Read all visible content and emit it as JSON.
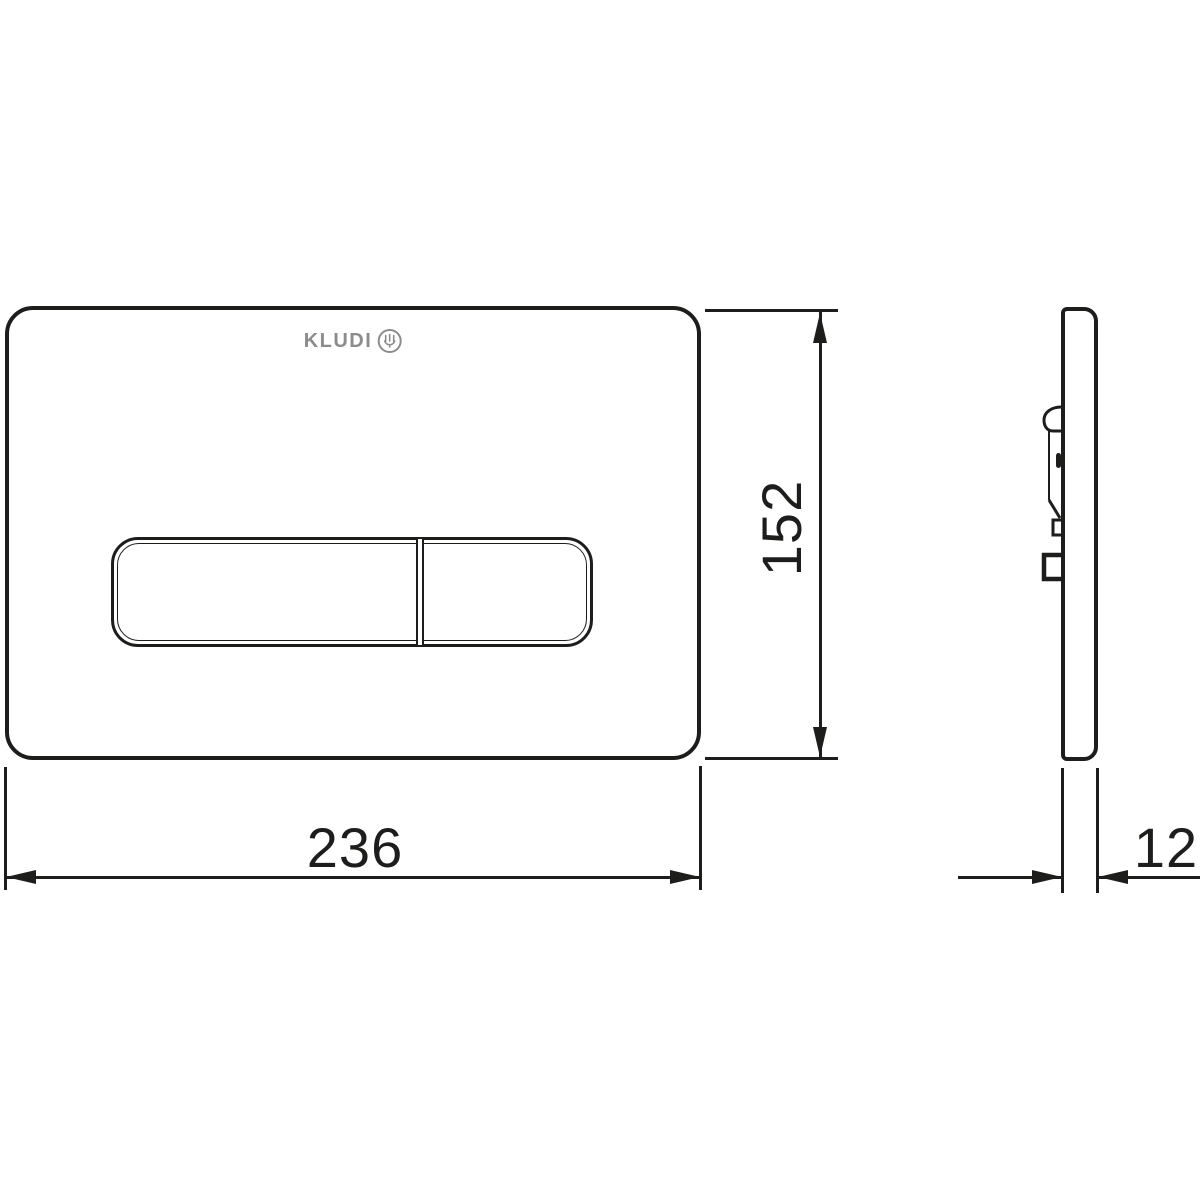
{
  "colors": {
    "background": "#ffffff",
    "line": "#1d1d1b",
    "logo_gray": "#8c8c8c"
  },
  "logo": {
    "brand": "KLUDI",
    "emblem": "kludi-water-hand-emblem"
  },
  "dimensions": {
    "plate_height_mm": {
      "value": "152"
    },
    "plate_width_mm": {
      "value": "236"
    },
    "plate_depth_mm": {
      "value": "12"
    }
  }
}
